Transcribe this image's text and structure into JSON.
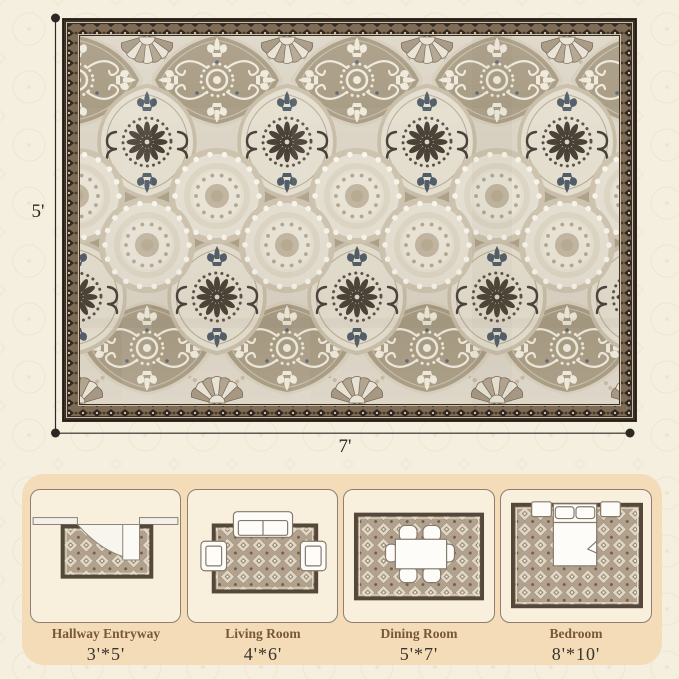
{
  "dimensions": {
    "height_label": "5'",
    "width_label": "7'"
  },
  "size_guide": {
    "rooms": [
      {
        "name": "Hallway Entryway",
        "size": "3'*5'"
      },
      {
        "name": "Living Room",
        "size": "4'*6'"
      },
      {
        "name": "Dining Room",
        "size": "5'*7'"
      },
      {
        "name": "Bedroom",
        "size": "8'*10'"
      }
    ]
  },
  "colors": {
    "page_bg": "#f5efdf",
    "panel_bg": "#f3dcb7",
    "card_bg": "#f8efdc",
    "label_brown": "#7a5837",
    "text_dark": "#2b2722",
    "rug_outer_border": "#3a3027",
    "rug_field_cream": "#dcd5c6",
    "rug_taupe": "#aca089"
  }
}
